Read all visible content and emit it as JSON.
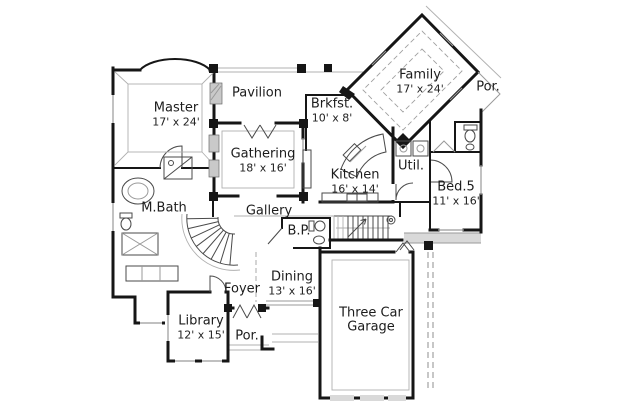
{
  "colors": {
    "background": "#ffffff",
    "wall": "#161616",
    "thin_line": "#4a4a4a",
    "eave_line": "#b0b0b0",
    "text": "#1c1c1c"
  },
  "rooms": {
    "master": {
      "label": "Master",
      "dims": "17' x 24'"
    },
    "pavilion": {
      "label": "Pavilion"
    },
    "brkfst": {
      "label": "Brkfst.",
      "dims": "10' x 8'"
    },
    "family": {
      "label": "Family",
      "dims": "17' x 24'"
    },
    "porch_right": {
      "label": "Por."
    },
    "gathering": {
      "label": "Gathering",
      "dims": "18' x 16'"
    },
    "kitchen": {
      "label": "Kitchen",
      "dims": "16' x 14'"
    },
    "util": {
      "label": "Util."
    },
    "bed5": {
      "label": "Bed.5",
      "dims": "11' x 16'"
    },
    "mbath": {
      "label": "M.Bath"
    },
    "gallery": {
      "label": "Gallery"
    },
    "powder": {
      "label": "B.P."
    },
    "dining": {
      "label": "Dining",
      "dims": "13' x 16'"
    },
    "foyer": {
      "label": "Foyer"
    },
    "library": {
      "label": "Library",
      "dims": "12' x 15'"
    },
    "porch_front": {
      "label": "Por."
    },
    "garage": {
      "label": "Three Car",
      "label2": "Garage"
    }
  }
}
